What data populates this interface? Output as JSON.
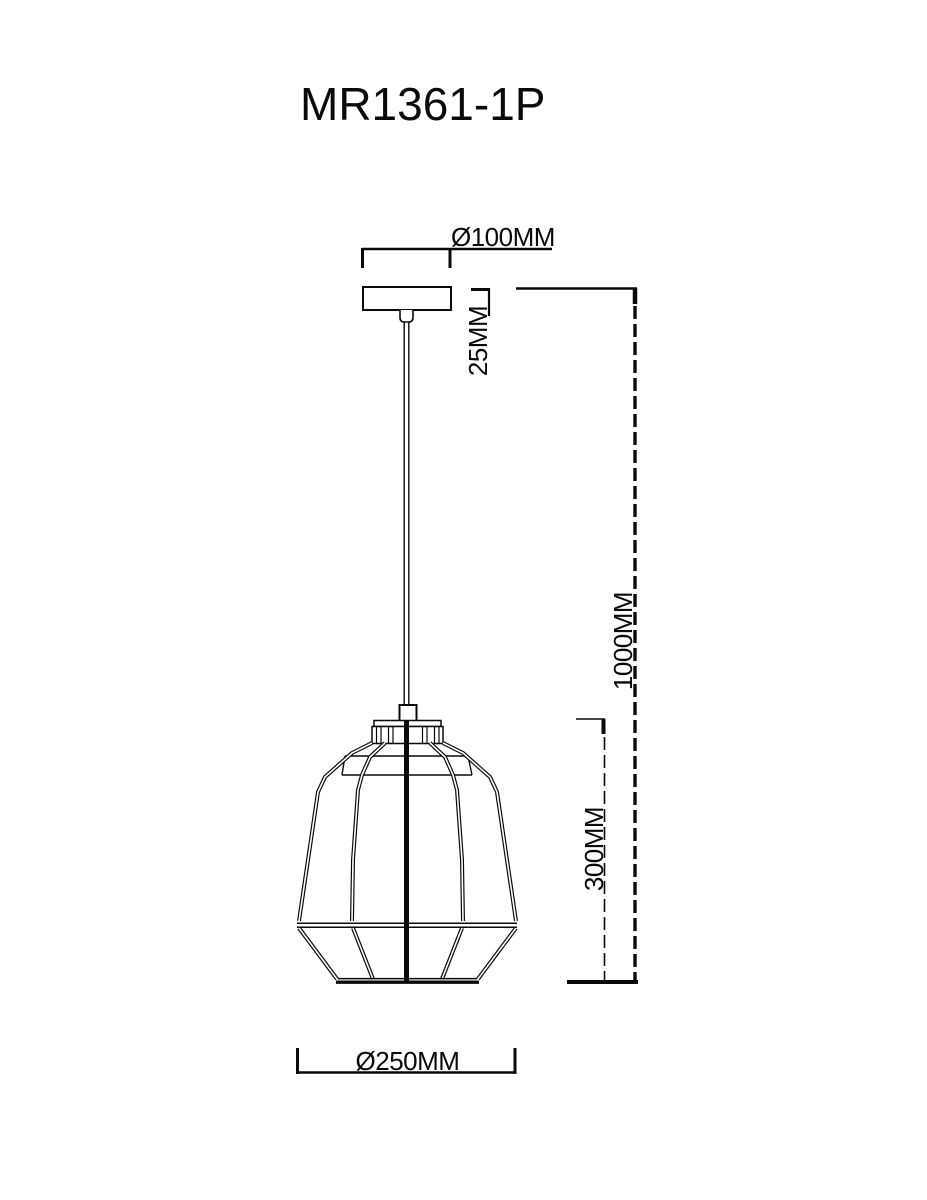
{
  "page": {
    "background": "#ffffff",
    "ink": "#0a0a0a",
    "kind": "pendant-lamp-dimension-drawing"
  },
  "title": "MR1361-1P",
  "labels": {
    "canopy_diameter": "Ø100MM",
    "canopy_height": "25MM",
    "overall_drop": "1000MM",
    "shade_height": "300MM",
    "shade_diameter": "Ø250MM"
  }
}
